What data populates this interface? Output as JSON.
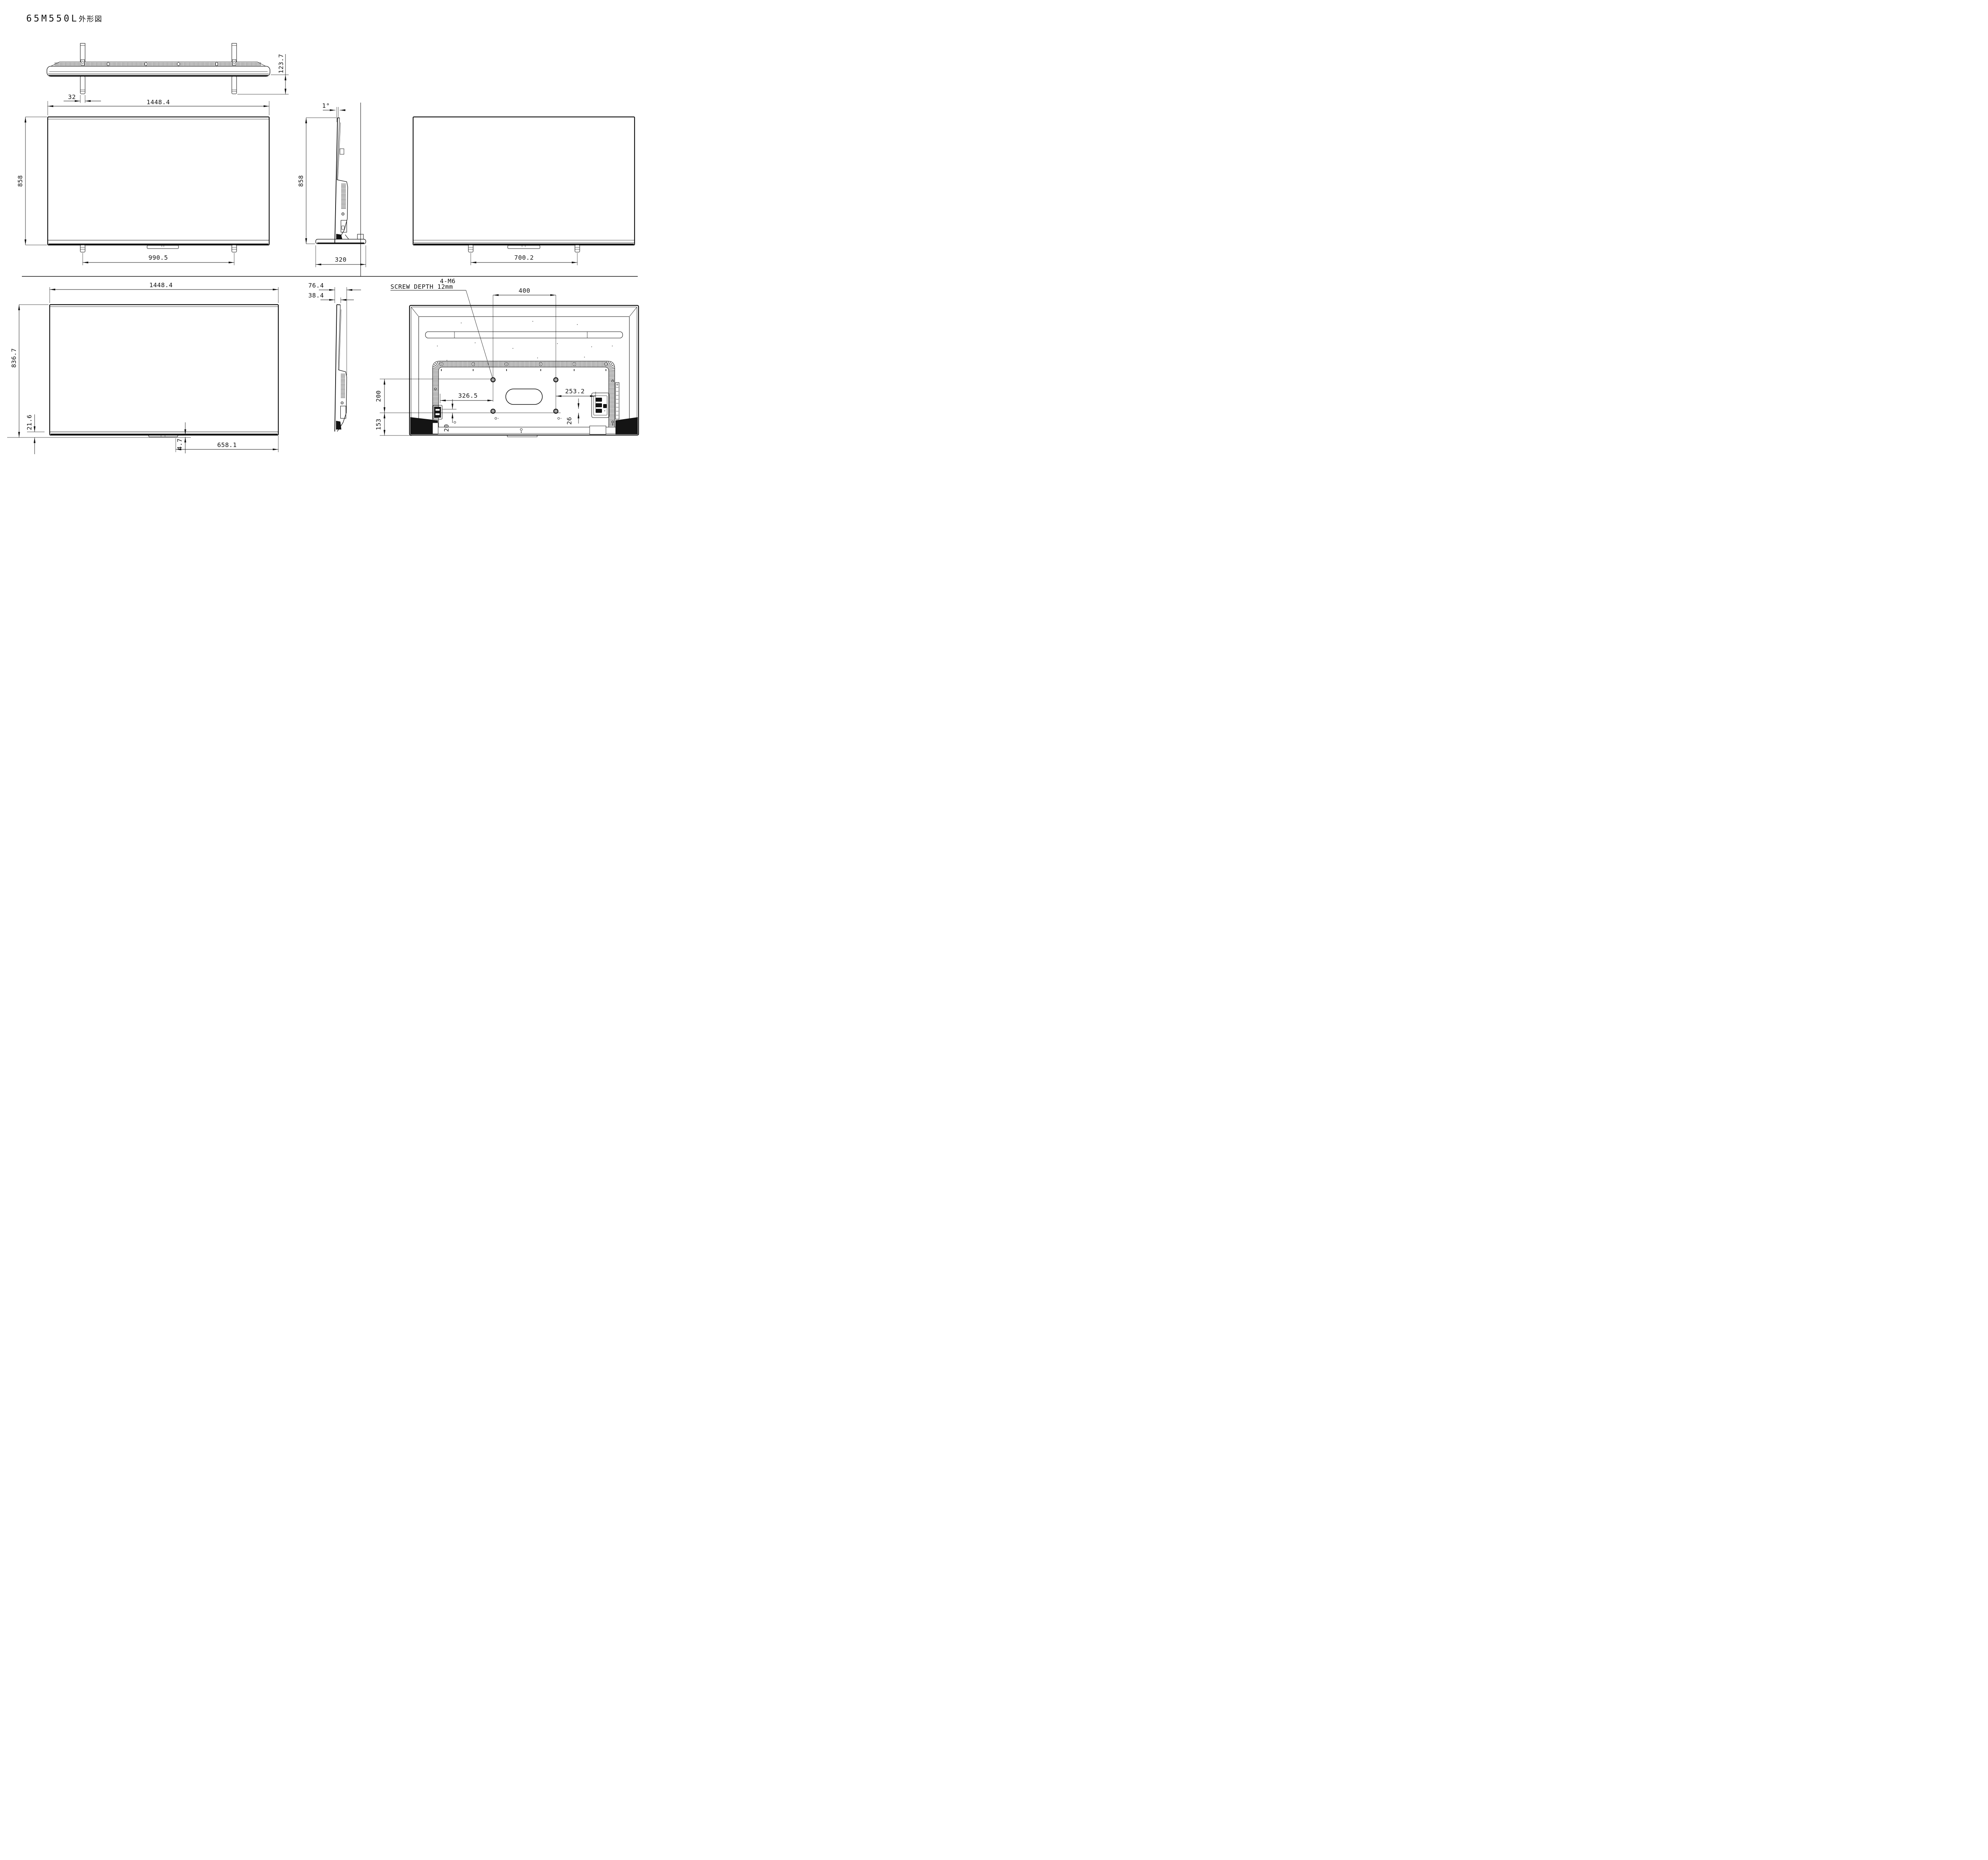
{
  "title": {
    "model": "65M550L",
    "doc_type": "外形図"
  },
  "views": {
    "top": {
      "dim_stand_leg_width": "32",
      "dim_overall_width": "1448.4",
      "dim_overall_depth": "123.7"
    },
    "front": {
      "dim_overall_height": "858",
      "dim_stand_feet_front_span": "990.5"
    },
    "side": {
      "dim_tilt_angle": "1°",
      "dim_overall_height": "858",
      "dim_stand_base_depth": "320"
    },
    "rear": {
      "dim_stand_feet_rear_span": "700.2"
    },
    "front_panel_only": {
      "dim_width": "1448.4",
      "dim_height": "836.7",
      "dim_bottom_bezel_height": "21.6",
      "dim_bottom_protrusion": "4.7",
      "dim_bottom_offset": "658.1"
    },
    "side_panel_only": {
      "dim_max_depth": "76.4",
      "dim_panel_depth": "38.4"
    },
    "rear_detail": {
      "screw_note_line1": "4-M6",
      "screw_note_line2": "SCREW DEPTH 12mm",
      "dim_vesa_width": "400",
      "dim_vesa_height": "200",
      "dim_vesa_to_bottom": "153",
      "dim_left_edge_to_vesa": "326.5",
      "dim_connector_offset_left": "20",
      "dim_vesa_to_right_feature": "253.2",
      "dim_connector_offset_right": "26"
    }
  }
}
